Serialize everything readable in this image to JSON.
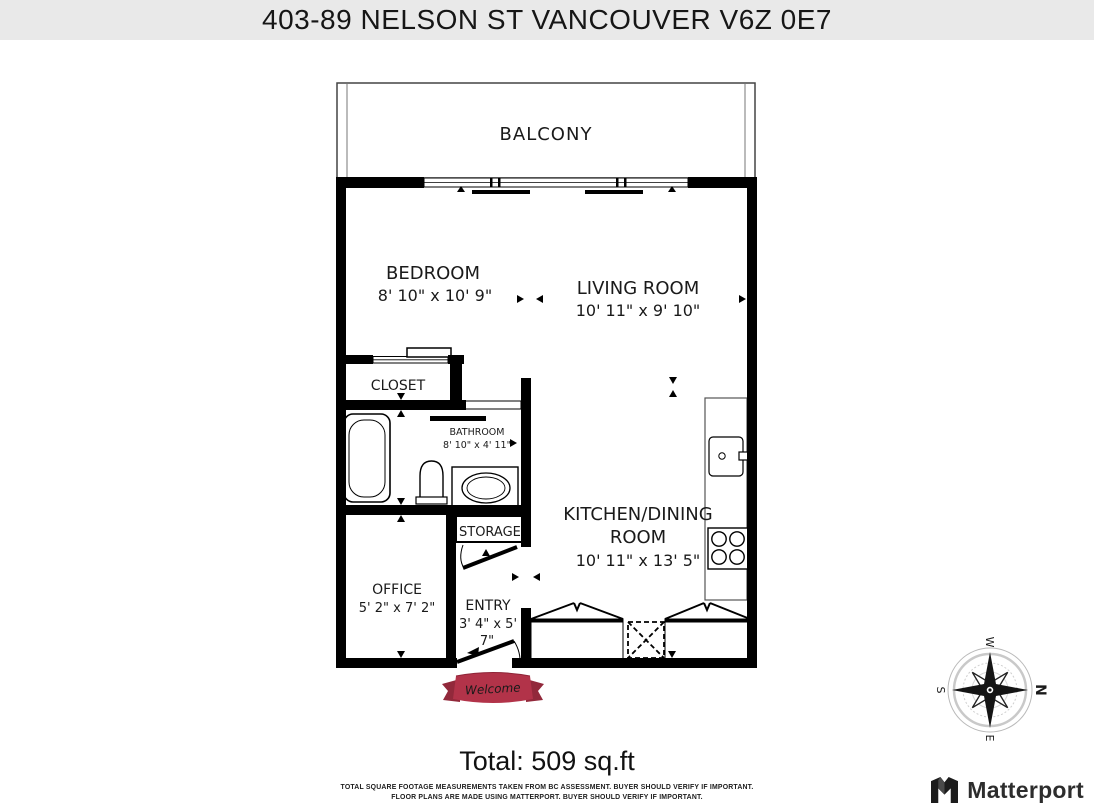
{
  "header": {
    "title": "403-89 NELSON ST VANCOUVER V6Z 0E7"
  },
  "rooms": {
    "balcony": {
      "name": "BALCONY"
    },
    "bedroom": {
      "name": "BEDROOM",
      "dims": "8' 10\" x 10' 9\""
    },
    "living": {
      "name": "LIVING ROOM",
      "dims": "10' 11\" x 9' 10\""
    },
    "closet": {
      "name": "CLOSET"
    },
    "bathroom": {
      "name": "BATHROOM",
      "dims": "8' 10\" x 4' 11\""
    },
    "kitchen": {
      "line1": "KITCHEN/DINING",
      "line2": "ROOM",
      "dims": "10' 11\" x 13' 5\""
    },
    "storage": {
      "name": "STORAGE"
    },
    "office": {
      "name": "OFFICE",
      "dims": "5' 2\" x 7' 2\""
    },
    "entry": {
      "name": "ENTRY",
      "dims1": "3' 4\" x 5'",
      "dims2": "7\""
    }
  },
  "compass": {
    "n": "N",
    "e": "E",
    "s": "S",
    "w": "W"
  },
  "welcome": {
    "text": "Welcome"
  },
  "footer": {
    "total": "Total: 509 sq.ft",
    "disclaimer1": "TOTAL SQUARE FOOTAGE MEASUREMENTS TAKEN FROM BC ASSESSMENT. BUYER SHOULD VERIFY IF IMPORTANT.",
    "disclaimer2": "FLOOR PLANS ARE MADE USING MATTERPORT. BUYER SHOULD VERIFY IF IMPORTANT."
  },
  "branding": {
    "label": "Matterport"
  },
  "colors": {
    "titlebar_bg": "#e9e9e9",
    "wall": "#000000",
    "welcome_ribbon": "#b23349",
    "welcome_ribbon_dark": "#92293b",
    "compass_north": "#c23030",
    "brand_text": "#2d2d2d"
  }
}
